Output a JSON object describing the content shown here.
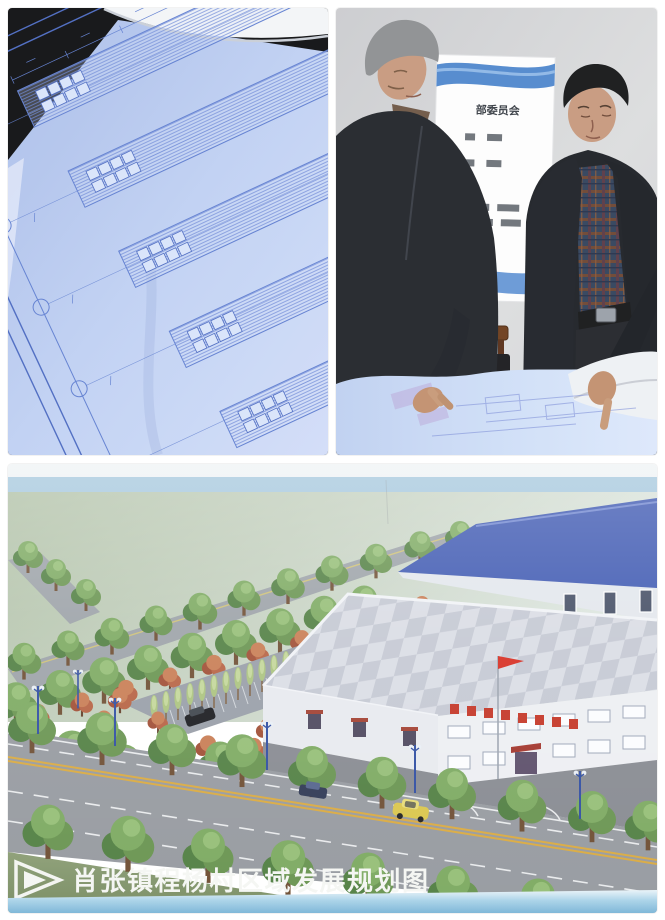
{
  "collage": {
    "caption": "肖张镇程杨村区域发展规划图",
    "sign_title": "部委员会",
    "panel_names": [
      "blueprint-closeup",
      "officials-reviewing-blueprint",
      "development-plan-rendering"
    ]
  },
  "colors": {
    "blueprint_paper": "#b9cbf0",
    "blueprint_line": "#5f7ed0",
    "photo_bg_dark": "#0d0e10",
    "wall": "#d7d8da",
    "jacket_dark": "#23262b",
    "skin": "#c79a7e",
    "sign_wave_blue": "#3f7cc9",
    "sky_band": "#a3c6dc",
    "field_green": "#b2c2a8",
    "road_gray": "#94989e",
    "lawn_green": "#7d9468",
    "tree_green": "#66924d",
    "shrub_red": "#b0573b",
    "roof_blue": "#3a55b0",
    "checker_light": "#d9dce4",
    "checker_dark": "#c3c7d2",
    "flag_red": "#d6281c",
    "roof_sign_red": "#c23020",
    "car_yellow": "#d9c548",
    "bottom_strip_blue": "#8fc3e0",
    "caption_color": "#f4f6f2"
  }
}
